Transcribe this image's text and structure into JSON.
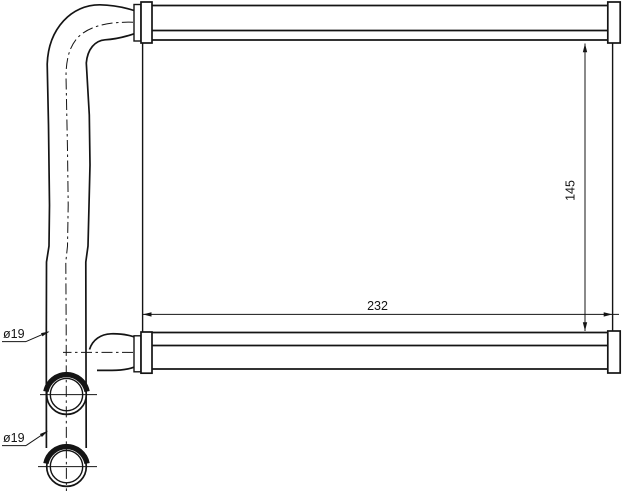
{
  "drawing": {
    "colors": {
      "line": "#141414",
      "background": "#ffffff"
    },
    "dimensions": {
      "core_width_mm": "232",
      "core_height_mm": "145",
      "top_pipe_diameter": "ø19",
      "bottom_pipe_diameter": "ø19"
    }
  }
}
